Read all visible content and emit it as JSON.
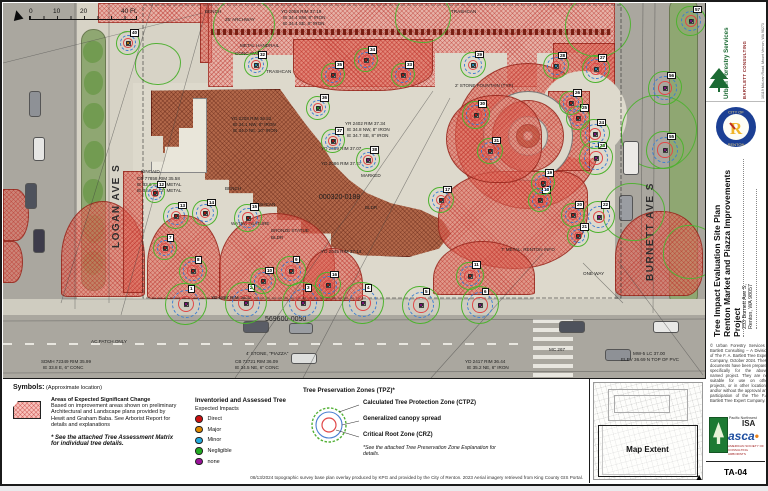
{
  "impact_colors": {
    "direct": "#cc1111",
    "major": "#dd8800",
    "minor": "#22aadd",
    "negligible": "#22aa22",
    "none": "#991199"
  },
  "map": {
    "scale_bar": {
      "l0": "0",
      "l1": "10",
      "l2": "20",
      "l3": "40 Ft."
    },
    "north_glyph": "▲",
    "streets": [
      {
        "name": "LOGAN AVE S"
      },
      {
        "name": "BURNETT AVE S"
      }
    ],
    "trees": [
      {
        "no": 1,
        "x": 183,
        "y": 301,
        "impact": "none",
        "r": 21
      },
      {
        "no": 2,
        "x": 243,
        "y": 300,
        "impact": "none",
        "r": 21
      },
      {
        "no": 3,
        "x": 300,
        "y": 300,
        "impact": "none",
        "r": 21
      },
      {
        "no": 4,
        "x": 360,
        "y": 300,
        "impact": "none",
        "r": 21
      },
      {
        "no": 5,
        "x": 418,
        "y": 302,
        "impact": "none",
        "r": 19
      },
      {
        "no": 6,
        "x": 477,
        "y": 302,
        "impact": "none",
        "r": 19
      },
      {
        "no": 22,
        "x": 596,
        "y": 214,
        "impact": "none",
        "r": 16
      },
      {
        "no": 23,
        "x": 593,
        "y": 155,
        "impact": "none",
        "r": 17
      },
      {
        "no": 24,
        "x": 592,
        "y": 131,
        "impact": "none",
        "r": 15
      },
      {
        "no": 55,
        "x": 662,
        "y": 147,
        "impact": "none",
        "r": 19
      },
      {
        "no": 56,
        "x": 662,
        "y": 85,
        "impact": "none",
        "r": 17
      },
      {
        "no": 57,
        "x": 688,
        "y": 18,
        "impact": "none",
        "r": 15
      },
      {
        "no": 38,
        "x": 365,
        "y": 157,
        "impact": "none",
        "r": 12
      },
      {
        "no": 27,
        "x": 593,
        "y": 66,
        "impact": "minor",
        "r": 14
      },
      {
        "no": 28,
        "x": 553,
        "y": 63,
        "impact": "minor",
        "r": 13
      },
      {
        "no": 29,
        "x": 470,
        "y": 62,
        "impact": "minor",
        "r": 13
      },
      {
        "no": 32,
        "x": 253,
        "y": 62,
        "impact": "minor",
        "r": 12
      },
      {
        "no": 7,
        "x": 162,
        "y": 245,
        "impact": "direct",
        "r": 12
      },
      {
        "no": 8,
        "x": 190,
        "y": 268,
        "impact": "direct",
        "r": 14
      },
      {
        "no": 9,
        "x": 288,
        "y": 268,
        "impact": "direct",
        "r": 15
      },
      {
        "no": 10,
        "x": 260,
        "y": 278,
        "impact": "direct",
        "r": 13
      },
      {
        "no": 11,
        "x": 467,
        "y": 273,
        "impact": "direct",
        "r": 14
      },
      {
        "no": 12,
        "x": 152,
        "y": 190,
        "impact": "direct",
        "r": 10
      },
      {
        "no": 13,
        "x": 173,
        "y": 213,
        "impact": "direct",
        "r": 13
      },
      {
        "no": 14,
        "x": 202,
        "y": 210,
        "impact": "direct",
        "r": 13
      },
      {
        "no": 15,
        "x": 245,
        "y": 215,
        "impact": "direct",
        "r": 14
      },
      {
        "no": 16,
        "x": 325,
        "y": 282,
        "impact": "direct",
        "r": 13
      },
      {
        "no": 17,
        "x": 438,
        "y": 197,
        "impact": "direct",
        "r": 13
      },
      {
        "no": 18,
        "x": 537,
        "y": 197,
        "impact": "direct",
        "r": 12
      },
      {
        "no": 19,
        "x": 540,
        "y": 180,
        "impact": "direct",
        "r": 12
      },
      {
        "no": 20,
        "x": 570,
        "y": 212,
        "impact": "direct",
        "r": 12
      },
      {
        "no": 21,
        "x": 575,
        "y": 233,
        "impact": "direct",
        "r": 11
      },
      {
        "no": 25,
        "x": 575,
        "y": 115,
        "impact": "direct",
        "r": 12
      },
      {
        "no": 26,
        "x": 568,
        "y": 100,
        "impact": "direct",
        "r": 12
      },
      {
        "no": 30,
        "x": 473,
        "y": 112,
        "impact": "direct",
        "r": 14
      },
      {
        "no": 31,
        "x": 487,
        "y": 148,
        "impact": "direct",
        "r": 13
      },
      {
        "no": 33,
        "x": 400,
        "y": 72,
        "impact": "direct",
        "r": 12
      },
      {
        "no": 34,
        "x": 363,
        "y": 57,
        "impact": "direct",
        "r": 12
      },
      {
        "no": 35,
        "x": 330,
        "y": 72,
        "impact": "direct",
        "r": 12
      },
      {
        "no": 37,
        "x": 330,
        "y": 138,
        "impact": "direct",
        "r": 12
      },
      {
        "no": 36,
        "x": 315,
        "y": 105,
        "impact": "negligible",
        "r": 12
      },
      {
        "no": 40,
        "x": 125,
        "y": 40,
        "impact": "major",
        "r": 12
      }
    ],
    "labels": [
      {
        "t": "BENCH",
        "x": 202,
        "y": 6
      },
      {
        "t": "25' ARCHWAY",
        "x": 222,
        "y": 14
      },
      {
        "t": "YD 2058 RIM 37.19",
        "x": 278,
        "y": 6
      },
      {
        "t": "IE 34.4 SW, 8\" IRON",
        "x": 280,
        "y": 12
      },
      {
        "t": "IE 34.4 SE, 8\" IRON",
        "x": 280,
        "y": 18
      },
      {
        "t": "METAL HANDRAIL",
        "x": 237,
        "y": 40
      },
      {
        "t": "CONC WALL",
        "x": 232,
        "y": 48
      },
      {
        "t": "TRASHCAN",
        "x": 263,
        "y": 66
      },
      {
        "t": "TRASHCAN",
        "x": 448,
        "y": 6
      },
      {
        "t": "YD 2208 RIM 36.52",
        "x": 228,
        "y": 113
      },
      {
        "t": "IE 34.1 NW, 8\" IRON",
        "x": 230,
        "y": 119
      },
      {
        "t": "IE 34.0 NE, 10\" IRON",
        "x": 230,
        "y": 125
      },
      {
        "t": "YR 2402 RIM 37.34",
        "x": 342,
        "y": 118
      },
      {
        "t": "IE 34.8 NW, 8\" IRON",
        "x": 344,
        "y": 124
      },
      {
        "t": "IE 34.7 SE, 8\" IRON",
        "x": 344,
        "y": 130
      },
      {
        "t": "YD 2089 RIM 37.07",
        "x": 318,
        "y": 143
      },
      {
        "t": "YD 2086 RIM 37.47",
        "x": 318,
        "y": 158
      },
      {
        "t": "MARKED",
        "x": 358,
        "y": 170
      },
      {
        "t": "000320-0188",
        "x": 316,
        "y": 192,
        "fs": 7
      },
      {
        "t": "BLDR",
        "x": 362,
        "y": 202
      },
      {
        "t": "BENCH",
        "x": 222,
        "y": 183
      },
      {
        "t": "TRASHCAN",
        "x": 247,
        "y": 199
      },
      {
        "t": "WATER FEATURE",
        "x": 228,
        "y": 218
      },
      {
        "t": "BRONZE STATUE",
        "x": 268,
        "y": 225
      },
      {
        "t": "BLDR",
        "x": 268,
        "y": 232
      },
      {
        "t": "KINCAID",
        "x": 138,
        "y": 166
      },
      {
        "t": "CB 77858 RIM 35.58",
        "x": 134,
        "y": 173
      },
      {
        "t": "IE 33.6 S, 12\" METAL",
        "x": 134,
        "y": 179
      },
      {
        "t": "IE 33.6 E, 12\" METAL",
        "x": 134,
        "y": 185
      },
      {
        "t": "YD 2045 RIM 37.14",
        "x": 318,
        "y": 246
      },
      {
        "t": "YD 1897 RIM 36.37",
        "x": 208,
        "y": 292
      },
      {
        "t": "569600-0050",
        "x": 262,
        "y": 314,
        "fs": 7
      },
      {
        "t": "4' STONE, \"PIAZZA\"",
        "x": 243,
        "y": 348
      },
      {
        "t": "CB 72721 RIM 36.09",
        "x": 232,
        "y": 356
      },
      {
        "t": "IE 34.5 NE, 6\" CONC",
        "x": 232,
        "y": 362
      },
      {
        "t": "SDMH 72349 RIM 35.99",
        "x": 38,
        "y": 356
      },
      {
        "t": "IE 33.8 E, 6\" CONC",
        "x": 40,
        "y": 362
      },
      {
        "t": "AC.PATCH.ONLY",
        "x": 88,
        "y": 336
      },
      {
        "t": "MC 267",
        "x": 546,
        "y": 344
      },
      {
        "t": "ONE WAY",
        "x": 580,
        "y": 268
      },
      {
        "t": "YD 2417 RIM 36.44",
        "x": 462,
        "y": 356
      },
      {
        "t": "IE 35.2 NE, 6\" IRON",
        "x": 464,
        "y": 362
      },
      {
        "t": "MW-5 LC 37.00",
        "x": 630,
        "y": 348
      },
      {
        "t": "ELEV 36.69 N TOP OF PVC",
        "x": 618,
        "y": 354
      },
      {
        "t": "2' STONE FOUNTAIN (TYP)",
        "x": 452,
        "y": 80
      },
      {
        "t": "7' METAL, RENTON INFO",
        "x": 498,
        "y": 244
      }
    ]
  },
  "legend": {
    "heading": "Symbols:",
    "heading_note": "(Approximate location)",
    "areas": {
      "title": "Areas of Expected Significant Change",
      "desc": "Based on improvement areas shown on preliminary Architectural and Landscape plans provided by Hewit and Graham Baba. See Arborist Report for details and explanations",
      "note": "* See the attached Tree Assessment Matrix for individual tree details."
    },
    "impacts": {
      "title": "Inventoried and Assessed Tree",
      "subtitle": "Expected Impacts",
      "items": [
        {
          "label": "Direct",
          "color": "#cc1111"
        },
        {
          "label": "Major",
          "color": "#dd8800"
        },
        {
          "label": "Minor",
          "color": "#22aadd"
        },
        {
          "label": "Negligible",
          "color": "#22aa22"
        },
        {
          "label": "none",
          "color": "#991199"
        }
      ]
    },
    "tpz": {
      "title": "Tree Preservation Zones (TPZ)*",
      "ctpz": "Calculated Tree Protection Zone (CTPZ)",
      "canopy": "Generalized canopy spread",
      "crz": "Critical Root Zone (CRZ)",
      "note": "*See the attached Tree Preservation Zone Explanation for details."
    },
    "attribution": "08/13/2024 topographic survey base plan overlay produced by KPG and provided by the City of Renton. 2023 Aerial imagery retrieved from King County GIS Portal."
  },
  "inset": {
    "label": "Map Extent",
    "north_glyph": "▲"
  },
  "titleblock": {
    "firm": {
      "name": "Urban Forestry Services",
      "sub": "BARTLETT CONSULTING",
      "addr": "10119 McLean Road, Mount Vernon, WA 98273",
      "web": "urbanforestryservices.com"
    },
    "seal": {
      "top": "CITY OF",
      "bottom": "RENTON",
      "letter": "R"
    },
    "title_line1": "Tree Impact Evaluation Site Plan",
    "title_line2": "Renton Market and Piazza Improvements Project",
    "address_line1": "233 Burnett Ave S,",
    "address_line2": "Renton, WA 98057",
    "copyright": "© Urban Forestry Services / Bartlett Consulting – A Division of The F. A. Bartlett Tree Expert Company, October 2024. These documents have been prepared specifically for the above-named project. They are not suitable for use on other projects, or in other locations, and/or without the approval and participation of the The F.A. Bartlett Tree Expert Company.",
    "logos": {
      "pnw": "Pacific Northwest",
      "isa": "ISA",
      "asca": "asca",
      "asca_caption": "AMERICAN SOCIETY OF CONSULTING ARBORISTS"
    },
    "sheet_no": "TA-04"
  }
}
